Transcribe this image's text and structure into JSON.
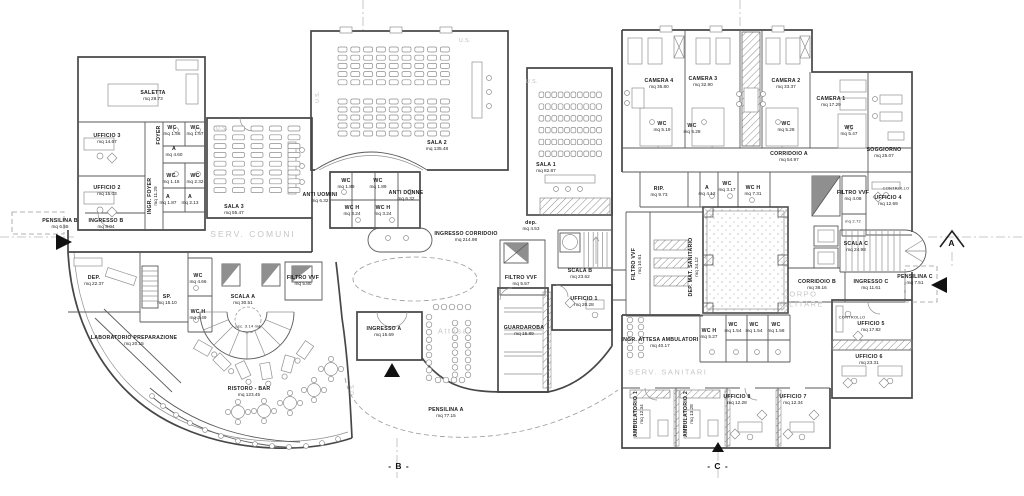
{
  "drawing": {
    "kind": "architectural floor plan",
    "unit": "mq"
  },
  "colors": {
    "wall": "#474747",
    "partition": "#5a5a5a",
    "zone_text": "#c6c6c6",
    "label_text": "#1c1c1c",
    "hatch": "#8a8a8a"
  },
  "labels": [
    {
      "t": "SALETTA",
      "a": "mq 28.73",
      "x": 153,
      "y": 96
    },
    {
      "t": "UFFICIO 3",
      "a": "mq 14.67",
      "x": 107,
      "y": 139
    },
    {
      "t": "UFFICIO 2",
      "a": "mq 15.03",
      "x": 107,
      "y": 191
    },
    {
      "t": "PENSILINA B",
      "a": "mq 6.55",
      "x": 60,
      "y": 224
    },
    {
      "t": "INGRESSO B",
      "a": "mq 8.04",
      "x": 106,
      "y": 224
    },
    {
      "t": "FOYER",
      "x": 159,
      "y": 135,
      "r": -90
    },
    {
      "t": "INGR. FOYER",
      "a": "mq 11.29",
      "x": 153,
      "y": 196,
      "r": -90
    },
    {
      "t": "WC",
      "a": "mq 1.56",
      "x": 172,
      "y": 131
    },
    {
      "t": "WC",
      "a": "mq 1.67",
      "x": 195,
      "y": 131
    },
    {
      "t": "A",
      "a": "mq 4.60",
      "x": 174,
      "y": 152
    },
    {
      "t": "WC",
      "a": "mq 1.15",
      "x": 171,
      "y": 179
    },
    {
      "t": "WC",
      "a": "mq 2.32",
      "x": 195,
      "y": 179
    },
    {
      "t": "A",
      "a": "mq 1.87",
      "x": 168,
      "y": 200
    },
    {
      "t": "A",
      "a": "mq 2.13",
      "x": 190,
      "y": 200
    },
    {
      "t": "SALA 3",
      "a": "mq 55.47",
      "x": 234,
      "y": 210
    },
    {
      "t": "SALA 2",
      "a": "mq 135.48",
      "x": 437,
      "y": 146
    },
    {
      "t": "WC",
      "a": "mq 1.89",
      "x": 346,
      "y": 184
    },
    {
      "t": "WC",
      "a": "mq 1.89",
      "x": 378,
      "y": 184
    },
    {
      "t": "ANTI UOMINI",
      "a": "mq 6.32",
      "x": 320,
      "y": 198
    },
    {
      "t": "ANTI DONNE",
      "a": "mq 6.32",
      "x": 406,
      "y": 196
    },
    {
      "t": "WC H",
      "a": "mq 3.24",
      "x": 352,
      "y": 211
    },
    {
      "t": "WC H",
      "a": "mq 3.24",
      "x": 383,
      "y": 211
    },
    {
      "t": "INGRESSO CORRIDOIO",
      "a": "mq 214.98",
      "x": 466,
      "y": 237
    },
    {
      "t": "SALA 1",
      "a": "mq 82.87",
      "x": 546,
      "y": 168
    },
    {
      "t": "dep.",
      "a": "mq 4.53",
      "x": 531,
      "y": 226
    },
    {
      "t": "SCALA B",
      "a": "mq 23.62",
      "x": 580,
      "y": 274
    },
    {
      "t": "FILTRO VVF",
      "a": "mq 5.57",
      "x": 521,
      "y": 281
    },
    {
      "t": "UFFICIO 1",
      "a": "mq 20.28",
      "x": 584,
      "y": 302
    },
    {
      "t": "GUARDAROBA",
      "a": "mq 15.89",
      "x": 524,
      "y": 331
    },
    {
      "t": "INGRESSO A",
      "a": "mq 15.69",
      "x": 384,
      "y": 332
    },
    {
      "t": "PENSILINA A",
      "a": "mq 77.15",
      "x": 446,
      "y": 413
    },
    {
      "t": "RISTORO - BAR",
      "a": "mq 123.45",
      "x": 249,
      "y": 392
    },
    {
      "t": "LABORATORIO PREPARAZIONE",
      "a": "mq 20.15",
      "x": 134,
      "y": 341
    },
    {
      "t": "DEP.",
      "a": "mq 22.37",
      "x": 94,
      "y": 281
    },
    {
      "t": "SP.",
      "a": "mq 15.10",
      "x": 167,
      "y": 300
    },
    {
      "t": "WC",
      "a": "mq 4.66",
      "x": 198,
      "y": 279
    },
    {
      "t": "WC H",
      "a": "mq 3.49",
      "x": 198,
      "y": 315
    },
    {
      "t": "SCALA A",
      "a": "mq 30.51",
      "x": 243,
      "y": 300
    },
    {
      "t": "asc. 3.14 mq",
      "x": 248,
      "y": 327,
      "s": "sm"
    },
    {
      "t": "FILTRO VVF",
      "a": "mq 5.80",
      "x": 303,
      "y": 281
    },
    {
      "t": "CAMERA 4",
      "a": "mq 35.80",
      "x": 659,
      "y": 84
    },
    {
      "t": "CAMERA 3",
      "a": "mq 32.90",
      "x": 703,
      "y": 82
    },
    {
      "t": "CAMERA 2",
      "a": "mq 33.37",
      "x": 786,
      "y": 84
    },
    {
      "t": "CAMERA 1",
      "a": "mq 17.29",
      "x": 831,
      "y": 102
    },
    {
      "t": "WC",
      "a": "mq 5.19",
      "x": 662,
      "y": 127
    },
    {
      "t": "WC",
      "a": "mq 5.28",
      "x": 692,
      "y": 129
    },
    {
      "t": "WC",
      "a": "mq 5.28",
      "x": 786,
      "y": 127
    },
    {
      "t": "WC",
      "a": "mq 5.47",
      "x": 849,
      "y": 131
    },
    {
      "t": "CORRIDOIO A",
      "a": "mq 54.97",
      "x": 789,
      "y": 157
    },
    {
      "t": "SOGGIORNO",
      "a": "mq 25.07",
      "x": 884,
      "y": 153
    },
    {
      "t": "RIP.",
      "a": "mq 9.73",
      "x": 659,
      "y": 192
    },
    {
      "t": "A",
      "a": "mq 4.12",
      "x": 707,
      "y": 191
    },
    {
      "t": "WC",
      "a": "mq 3.17",
      "x": 727,
      "y": 187
    },
    {
      "t": "WC H",
      "a": "mq 7.31",
      "x": 753,
      "y": 191
    },
    {
      "t": "FILTRO VVF",
      "a": "mq 4.08",
      "x": 853,
      "y": 196
    },
    {
      "t": "mq 2.72",
      "x": 853,
      "y": 222,
      "s": "sm"
    },
    {
      "t": "UFFICIO 4",
      "a": "mq 12.69",
      "x": 888,
      "y": 201
    },
    {
      "t": "CONTROLLO",
      "x": 896,
      "y": 189,
      "s": "sm"
    },
    {
      "t": "SCALA C",
      "a": "mq 24.98",
      "x": 856,
      "y": 247
    },
    {
      "t": "CORRIDOIO B",
      "a": "mq 38.16",
      "x": 817,
      "y": 285
    },
    {
      "t": "INGRESSO C",
      "a": "mq 11.61",
      "x": 871,
      "y": 285
    },
    {
      "t": "PENSILINA C",
      "a": "mq 7.51",
      "x": 915,
      "y": 280
    },
    {
      "t": "DEP. MAT. SANITARIO",
      "a": "mq 34.12",
      "x": 694,
      "y": 267,
      "r": -90
    },
    {
      "t": "FILTRO VVF",
      "a": "mq 10.61",
      "x": 637,
      "y": 264,
      "r": -90
    },
    {
      "t": "INGR. ATTESA AMBULATORI",
      "a": "mq 40.17",
      "x": 660,
      "y": 343
    },
    {
      "t": "WC H",
      "a": "mq 5.27",
      "x": 709,
      "y": 334
    },
    {
      "t": "WC",
      "a": "mq 1.54",
      "x": 733,
      "y": 328
    },
    {
      "t": "WC",
      "a": "mq 1.54",
      "x": 754,
      "y": 328
    },
    {
      "t": "WC",
      "a": "mq 1.58",
      "x": 776,
      "y": 328
    },
    {
      "t": "AMBULATORIO 1",
      "a": "mq 12.34",
      "x": 639,
      "y": 414,
      "r": -90
    },
    {
      "t": "AMBULATORIO 2",
      "a": "mq 13.28",
      "x": 689,
      "y": 414,
      "r": -90
    },
    {
      "t": "UFFICIO 8",
      "a": "mq 12.28",
      "x": 737,
      "y": 400
    },
    {
      "t": "UFFICIO 7",
      "a": "mq 12.34",
      "x": 793,
      "y": 400
    },
    {
      "t": "UFFICIO 6",
      "a": "mq 23.31",
      "x": 869,
      "y": 360
    },
    {
      "t": "UFFICIO 5",
      "a": "mq 17.82",
      "x": 871,
      "y": 327
    },
    {
      "t": "CONTROLLO",
      "x": 852,
      "y": 318,
      "s": "sm"
    }
  ],
  "zone_texts": [
    {
      "t": "SERV. COMUNI",
      "x": 253,
      "y": 234,
      "cls": ""
    },
    {
      "t": "CORPO",
      "x": 800,
      "y": 294,
      "cls": "small"
    },
    {
      "t": "MILITARE",
      "x": 801,
      "y": 304,
      "cls": "small"
    },
    {
      "t": "SERV. SANITARI",
      "x": 668,
      "y": 372,
      "cls": "small"
    },
    {
      "t": "Attesa",
      "x": 453,
      "y": 331,
      "cls": "small"
    }
  ],
  "us_text": "U.S.",
  "us_labels": [
    {
      "x": 222,
      "y": 129
    },
    {
      "x": 465,
      "y": 41
    },
    {
      "x": 532,
      "y": 82
    },
    {
      "x": 318,
      "y": 97,
      "r": -90
    },
    {
      "x": 353,
      "y": 389,
      "r": -90
    }
  ],
  "section_markers": [
    {
      "t": "- B -",
      "x": 399,
      "y": 466
    },
    {
      "t": "- C -",
      "x": 718,
      "y": 466
    },
    {
      "t": "A",
      "x": 952,
      "y": 243
    }
  ]
}
